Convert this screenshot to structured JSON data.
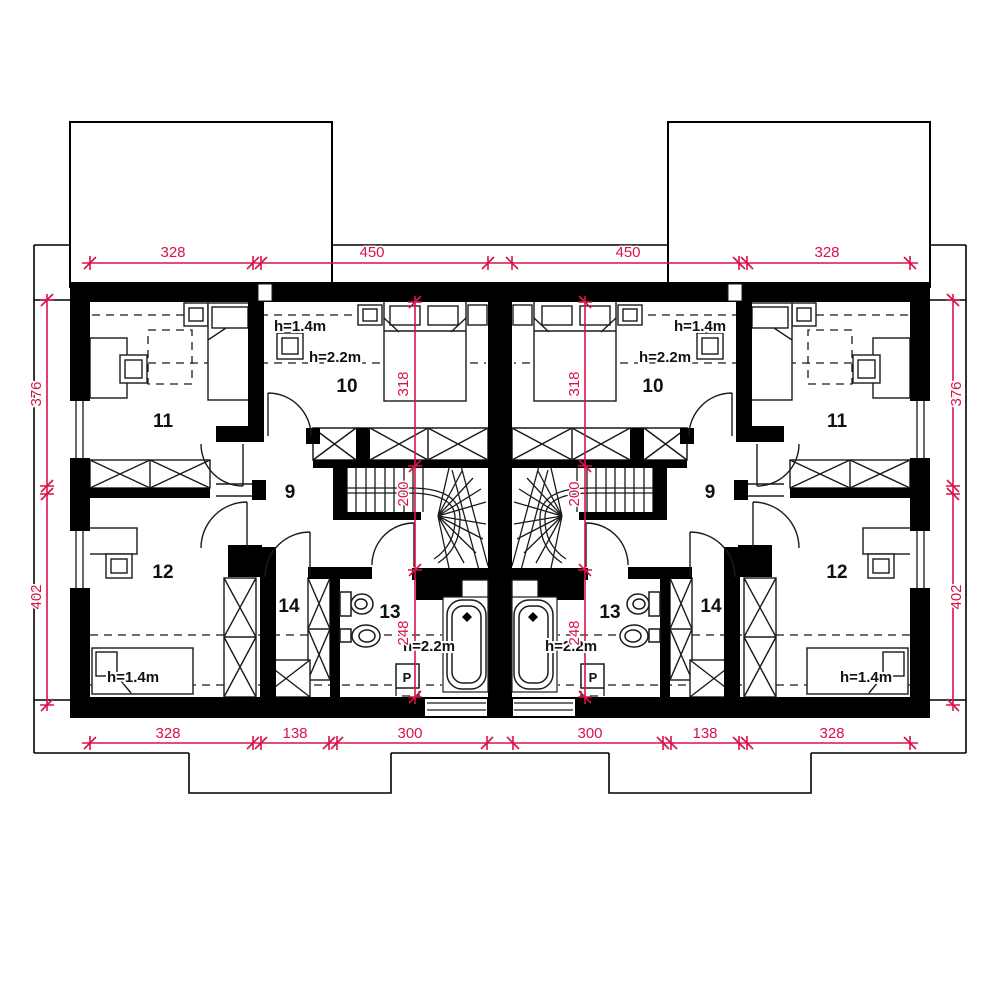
{
  "drawing": {
    "type": "floor-plan",
    "description": "Attic storey plan of a mirrored twin (semi-detached) house",
    "units": 2,
    "colors": {
      "walls": "#000000",
      "dimension_red": "#d81348",
      "background": "#ffffff"
    }
  },
  "rooms": [
    {
      "id": "9-left",
      "label": "9",
      "x": 290,
      "y": 498
    },
    {
      "id": "10-left",
      "label": "10",
      "x": 347,
      "y": 392
    },
    {
      "id": "11-left",
      "label": "11",
      "x": 163,
      "y": 427
    },
    {
      "id": "12-left",
      "label": "12",
      "x": 163,
      "y": 578
    },
    {
      "id": "13-left",
      "label": "13",
      "x": 390,
      "y": 618
    },
    {
      "id": "14-left",
      "label": "14",
      "x": 289,
      "y": 612
    },
    {
      "id": "9-right",
      "label": "9",
      "x": 710,
      "y": 498
    },
    {
      "id": "10-right",
      "label": "10",
      "x": 653,
      "y": 392
    },
    {
      "id": "11-right",
      "label": "11",
      "x": 837,
      "y": 427
    },
    {
      "id": "12-right",
      "label": "12",
      "x": 837,
      "y": 578
    },
    {
      "id": "13-right",
      "label": "13",
      "x": 610,
      "y": 618
    },
    {
      "id": "14-right",
      "label": "14",
      "x": 711,
      "y": 612
    }
  ],
  "height_labels": [
    {
      "text": "h=1.4m",
      "x": 300,
      "y": 331
    },
    {
      "text": "h=2.2m",
      "x": 335,
      "y": 362
    },
    {
      "text": "h=1.4m",
      "x": 133,
      "y": 682
    },
    {
      "text": "h=2.2m",
      "x": 429,
      "y": 651
    },
    {
      "text": "h=1.4m",
      "x": 700,
      "y": 331
    },
    {
      "text": "h=2.2m",
      "x": 665,
      "y": 362
    },
    {
      "text": "h=1.4m",
      "x": 866,
      "y": 682
    },
    {
      "text": "h=2.2m",
      "x": 571,
      "y": 651
    }
  ],
  "appliance_labels": [
    {
      "text": "P",
      "x": 407,
      "y": 682
    },
    {
      "text": "P",
      "x": 593,
      "y": 682
    }
  ],
  "dimensions": {
    "top": [
      {
        "value": "328",
        "x": 173,
        "y": 257
      },
      {
        "value": "450",
        "x": 372,
        "y": 257
      },
      {
        "value": "450",
        "x": 628,
        "y": 257
      },
      {
        "value": "328",
        "x": 827,
        "y": 257
      }
    ],
    "bottom": [
      {
        "value": "328",
        "x": 168,
        "y": 738
      },
      {
        "value": "138",
        "x": 295,
        "y": 738
      },
      {
        "value": "300",
        "x": 410,
        "y": 738
      },
      {
        "value": "300",
        "x": 590,
        "y": 738
      },
      {
        "value": "138",
        "x": 705,
        "y": 738
      },
      {
        "value": "328",
        "x": 832,
        "y": 738
      }
    ],
    "left_side": [
      {
        "value": "376",
        "x": 41,
        "y": 394,
        "rotated": true
      },
      {
        "value": "402",
        "x": 41,
        "y": 597,
        "rotated": true
      }
    ],
    "right_side": [
      {
        "value": "376",
        "x": 961,
        "y": 394,
        "rotated": true
      },
      {
        "value": "402",
        "x": 961,
        "y": 597,
        "rotated": true
      }
    ],
    "interior": [
      {
        "value": "318",
        "x": 408,
        "y": 384,
        "rotated": true
      },
      {
        "value": "200",
        "x": 408,
        "y": 494,
        "rotated": true
      },
      {
        "value": "248",
        "x": 408,
        "y": 633,
        "rotated": true
      },
      {
        "value": "318",
        "x": 579,
        "y": 384,
        "rotated": true
      },
      {
        "value": "200",
        "x": 579,
        "y": 494,
        "rotated": true
      },
      {
        "value": "248",
        "x": 579,
        "y": 633,
        "rotated": true
      }
    ]
  }
}
